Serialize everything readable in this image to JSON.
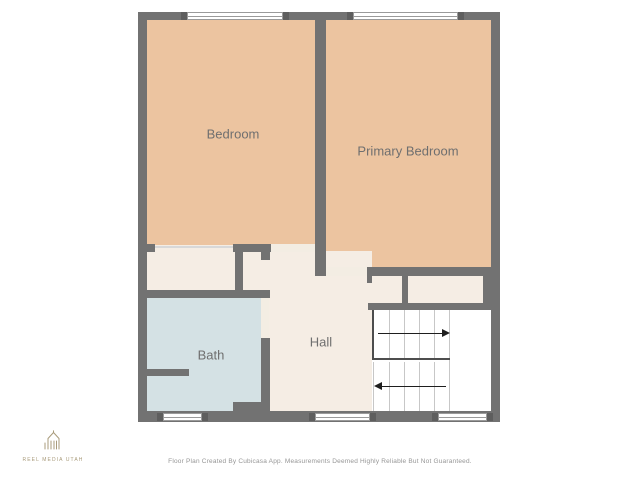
{
  "plan": {
    "rooms": [
      {
        "id": "bedroom",
        "label": "Bedroom"
      },
      {
        "id": "primary_bedroom",
        "label": "Primary Bedroom"
      },
      {
        "id": "bath",
        "label": "Bath"
      },
      {
        "id": "hall",
        "label": "Hall"
      }
    ],
    "stairs": {
      "type": "u-shaped",
      "upper_flight_arrow_direction": "right",
      "lower_flight_arrow_direction": "left"
    },
    "windows": {
      "top_wall_count": 2,
      "bottom_wall_count": 3
    },
    "colors": {
      "wall": "#727272",
      "room_warm": "#ECC4A0",
      "room_cream": "#F5EDE4",
      "door_strip": "#F3EDE3",
      "open_line": "#D8D8D8",
      "bath": "#D4E1E4",
      "stairs": "#FFFFFF",
      "tread": "#C7C7C7",
      "outline": "#4d4d4d",
      "arrow": "#1e1e1e",
      "window_frame": "#9a9a9a",
      "label_text": "#6F6F6F",
      "logo": "#A99B7B"
    }
  },
  "branding": {
    "logo_text": "REEL MEDIA UTAH"
  },
  "footer": {
    "disclaimer": "Floor Plan Created By Cubicasa App. Measurements Deemed Highly Reliable But Not Guaranteed."
  }
}
